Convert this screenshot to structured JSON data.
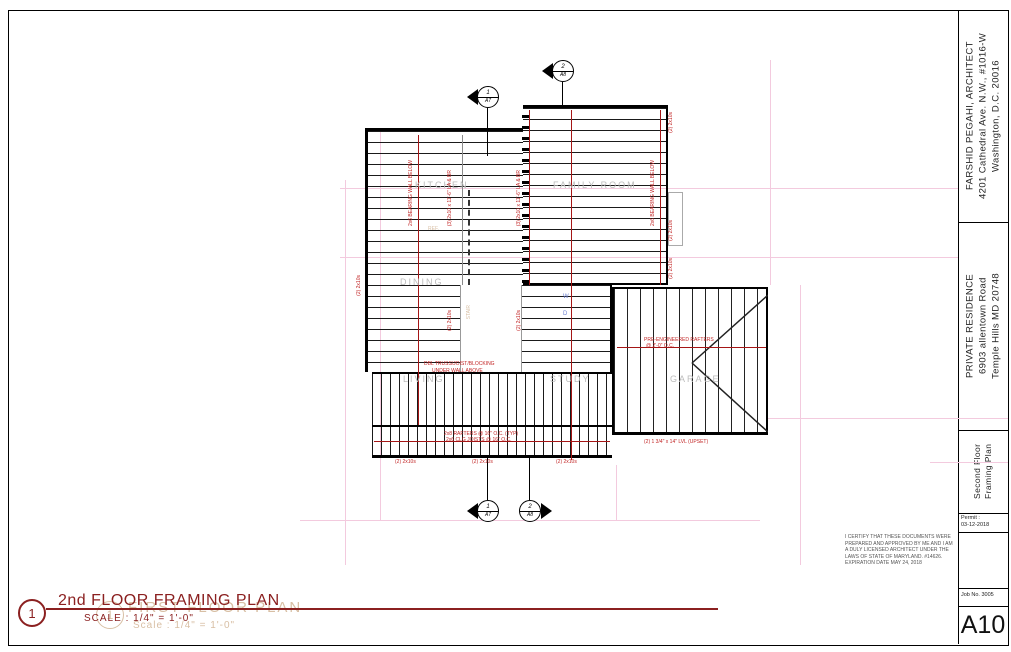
{
  "title_block": {
    "architect": {
      "line1": "FARSHID PEGAHI, ARCHITECT",
      "line2": "4201 Cathedral Ave. N.W., #1016-W",
      "line3": "Washington, D.C. 20016"
    },
    "project": {
      "line1": "PRIVATE RESIDENCE",
      "line2": "6903 allentown Road",
      "line3": "Temple Hills MD 20748"
    },
    "sheet_title": {
      "line1": "Second Floor",
      "line2": "Framing Plan"
    },
    "permit": {
      "label": "Permit :",
      "date": "03-12-2018"
    },
    "job": {
      "label": "Job No. 3005"
    },
    "sheet_number": "A10"
  },
  "drawing_title": {
    "detail_number": "1",
    "title": "2nd FLOOR FRAMING PLAN",
    "scale": "SCALE :  1/4\" = 1'-0\"",
    "ghost_detail_number": "1",
    "ghost_title": "FIRST FLOOR PLAN",
    "ghost_scale": "Scale : 1/4\" = 1'-0\""
  },
  "certification": {
    "line1": "I CERTIFY THAT THESE DOCUMENTS WERE",
    "line2": "PREPARED AND APPROVED BY ME AND I AM",
    "line3": "A DULY LICENSED ARCHITECT UNDER THE",
    "line4": "LAWS OF STATE OF MARYLAND. #14626.",
    "line5": "EXPIRATION DATE MAY 24, 2018"
  },
  "plan": {
    "rooms": {
      "kitchen": "KITCHEN",
      "family_room": "FAMILY ROOM",
      "dining": "DINING",
      "living": "LIVING",
      "study": "STUDY",
      "garage": "GARAGE"
    },
    "ghost_labels": {
      "ref": "REF.",
      "stair": "STAIR"
    },
    "appliances": {
      "washer": "W",
      "dryer": "D"
    },
    "markers": {
      "section1": {
        "number": "1",
        "sheet": "A7"
      },
      "section2": {
        "number": "2",
        "sheet": "A8"
      }
    },
    "annotations": [
      {
        "text": "(2) 2x10s"
      },
      {
        "text": "(2) 2x10s"
      },
      {
        "text": "(2) 2x10s"
      },
      {
        "text": "2x6 BEARING WALL BELOW"
      },
      {
        "text": "(3) 2x10 x 11'-6\" LA & BR"
      },
      {
        "text": "(3) 2x10 x 11'-6\" LA & BR"
      },
      {
        "text": "2x6 BEARING WALL BELOW"
      },
      {
        "text": "(2) 2x10s"
      },
      {
        "text": "(2) 2x10s"
      },
      {
        "text": "(2) 2x10s"
      },
      {
        "text": "DBL TRUSS/JOIST/BLOCKING"
      },
      {
        "text": "UNDER WALL ABOVE"
      },
      {
        "text": "PRE-ENGINEERED RAFTERS"
      },
      {
        "text": "@ 2'-0\" O.C."
      },
      {
        "text": "2x8 RAFTERS @ 16\" O.C. (TYP)"
      },
      {
        "text": "2x6 CLG JOISTS @ 16\" O.C."
      },
      {
        "text": "(2) 1 3/4\" x 14\" LVL (UPSET)"
      },
      {
        "text": "(2) 2x10s"
      },
      {
        "text": "(2) 2x10s"
      },
      {
        "text": "(2) 2x10s"
      }
    ]
  },
  "colors": {
    "accent_red": "#8B2020",
    "line_red": "#A51616",
    "annotation_red": "#C22525",
    "ghost_tan": "#D8BFA4",
    "room_gray": "#BCBCBC",
    "construction_pink": "#F3CADE"
  }
}
